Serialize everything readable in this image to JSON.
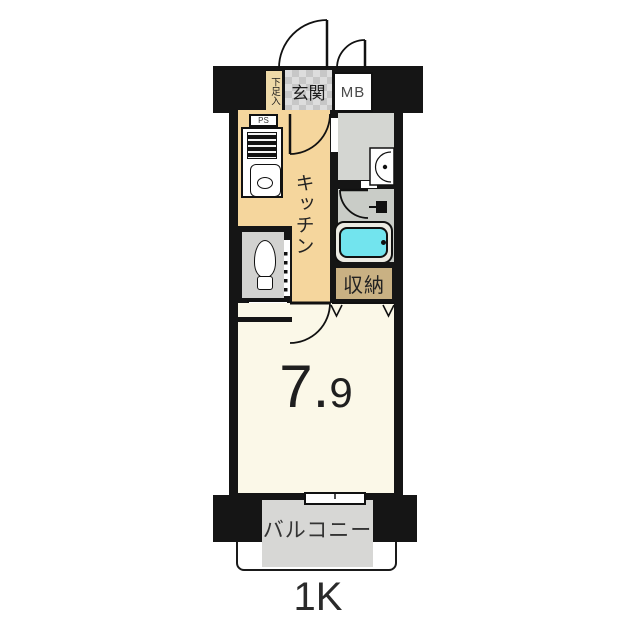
{
  "floor_plan": {
    "layout_type": "1K",
    "entrance": {
      "label": "玄関",
      "shoe_cabinet_label": "下足入",
      "meter_box_label": "MB"
    },
    "kitchen": {
      "label": "キッチン",
      "pipe_space_label": "PS"
    },
    "toilet": {
      "pipe_space_label": "PS"
    },
    "closet": {
      "label": "収納"
    },
    "main_room": {
      "size_tatami": "7.9",
      "size_integer": "7.",
      "size_decimal": "9"
    },
    "balcony": {
      "label": "バルコニー"
    },
    "colors": {
      "wall": "#151515",
      "kitchen_floor": "#f5d69d",
      "closet_floor": "#c9b183",
      "washroom_floor": "#d4d6d2",
      "bathtub": "#72e4ee",
      "main_room_floor": "#fbf8e8",
      "balcony_floor": "#d7d7d5"
    }
  }
}
